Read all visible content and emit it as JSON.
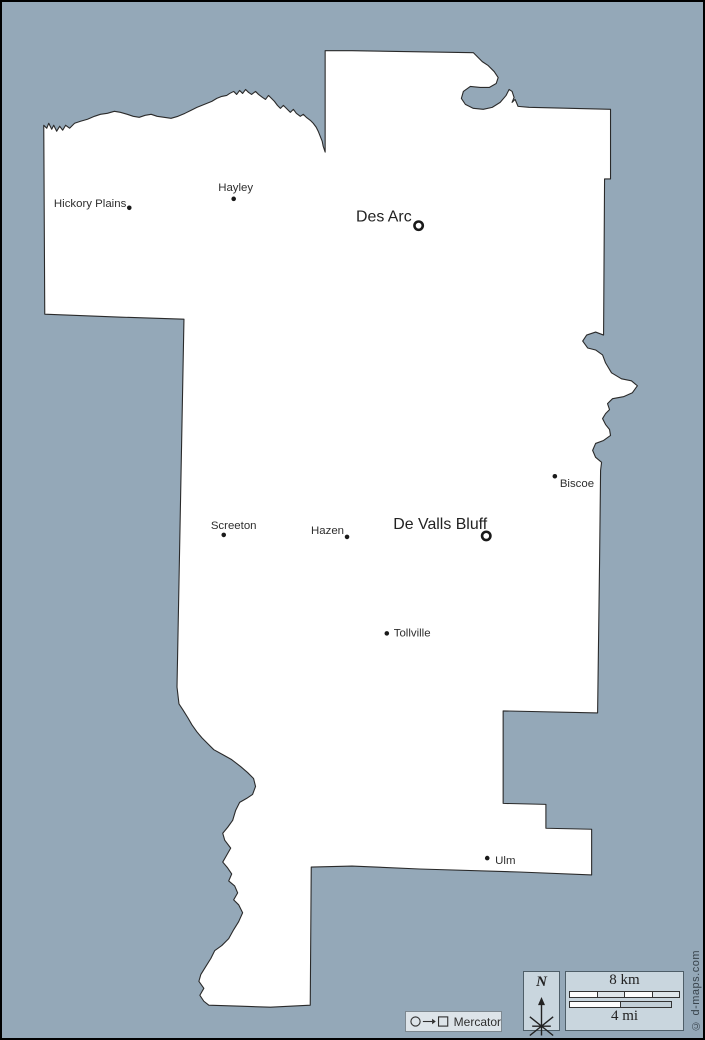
{
  "colors": {
    "sea": "#94a8b8",
    "land": "#ffffff",
    "outline": "#2a2a2a",
    "panel_bg": "#c9d6de",
    "panel_border": "#4e5e68"
  },
  "cities": [
    {
      "name": "Hickory Plains",
      "marker": "dot",
      "size": "small"
    },
    {
      "name": "Hayley",
      "marker": "dot",
      "size": "small"
    },
    {
      "name": "Des Arc",
      "marker": "ring",
      "size": "large"
    },
    {
      "name": "Biscoe",
      "marker": "dot",
      "size": "small"
    },
    {
      "name": "Screeton",
      "marker": "dot",
      "size": "small"
    },
    {
      "name": "Hazen",
      "marker": "dot",
      "size": "small"
    },
    {
      "name": "De Valls Bluff",
      "marker": "ring",
      "size": "large"
    },
    {
      "name": "Tollville",
      "marker": "dot",
      "size": "small"
    },
    {
      "name": "Ulm",
      "marker": "dot",
      "size": "small"
    }
  ],
  "compass": {
    "north_label": "N"
  },
  "scale": {
    "km_label": "8 km",
    "mi_label": "4 mi"
  },
  "projection": {
    "name": "Mercator"
  },
  "credit": "© d-maps.com"
}
